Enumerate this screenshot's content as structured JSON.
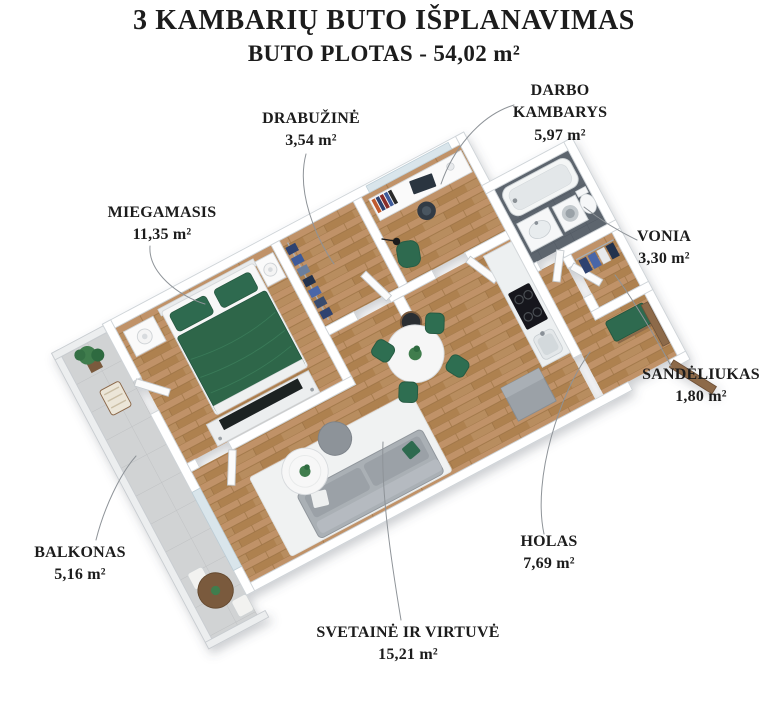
{
  "header": {
    "title": "3 KAMBARIŲ BUTO IŠPLANAVIMAS",
    "subtitle": "BUTO PLOTAS - 54,02 m²"
  },
  "labels": {
    "miegamasis": {
      "name": "MIEGAMASIS",
      "area": "11,35 m²"
    },
    "drabuzine": {
      "name": "DRABUŽINĖ",
      "area": "3,54 m²"
    },
    "darbo": {
      "name": "DARBO KAMBARYS",
      "area": "5,97 m²"
    },
    "vonia": {
      "name": "VONIA",
      "area": "3,30 m²"
    },
    "sandeliukas": {
      "name": "SANDĖLIUKAS",
      "area": "1,80 m²"
    },
    "balkonas": {
      "name": "BALKONAS",
      "area": "5,16 m²"
    },
    "holas": {
      "name": "HOLAS",
      "area": "7,69 m²"
    },
    "svetaine": {
      "name": "SVETAINĖ IR VIRTUVĖ",
      "area": "15,21 m²"
    }
  },
  "palette": {
    "accent_green": "#2e6b4f",
    "wood_floor": "#b88d5e",
    "balcony_floor": "#d1d3d4",
    "bath_tile": "#5d656e",
    "wall": "#ffffff",
    "text": "#1c1c1c",
    "leader_line": "#8e9398",
    "wood_furniture": "#8d6a4a"
  }
}
